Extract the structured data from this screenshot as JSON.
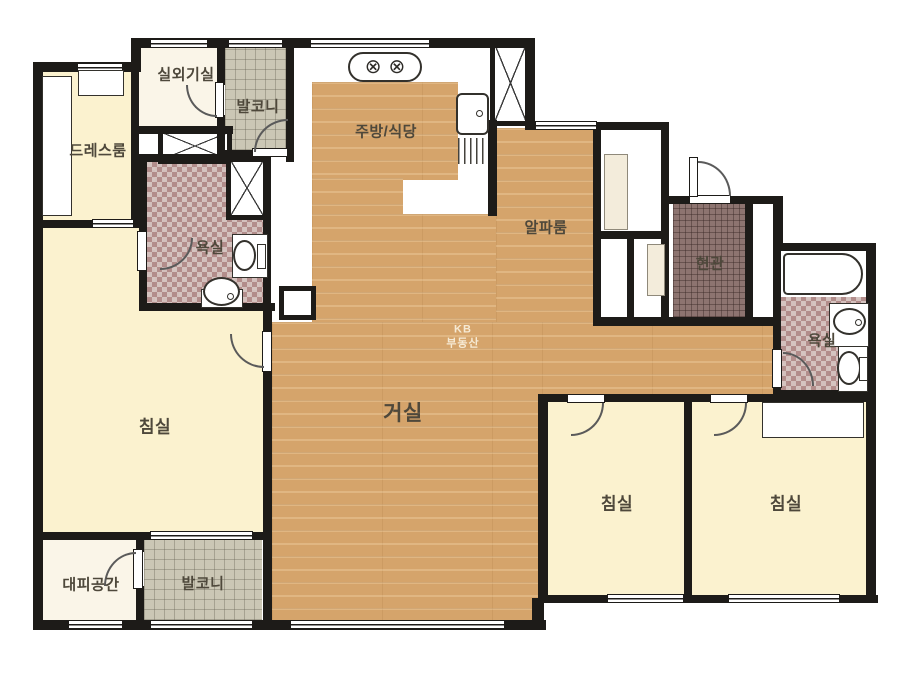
{
  "watermark": {
    "line1": "KB",
    "line2": "부동산"
  },
  "rooms": {
    "outdoor_unit": {
      "label": "실외기실"
    },
    "balcony_top": {
      "label": "발코니"
    },
    "dress_room": {
      "label": "드레스룸"
    },
    "bath_left": {
      "label": "욕실"
    },
    "kitchen_dining": {
      "label": "주방/식당"
    },
    "alpha_room": {
      "label": "알파룸"
    },
    "entrance": {
      "label": "현관"
    },
    "bath_right": {
      "label": "욕실"
    },
    "bedroom_left": {
      "label": "침실"
    },
    "living_room": {
      "label": "거실"
    },
    "evacuation_space": {
      "label": "대피공간"
    },
    "balcony_bottom": {
      "label": "발코니"
    },
    "bedroom_center": {
      "label": "침실"
    },
    "bedroom_right": {
      "label": "침실"
    }
  },
  "colors": {
    "wall": "#1d1b18",
    "wood_floor": "#d5a46b",
    "cream_room": "#fbf2cf",
    "off_white_room": "#faf5e8",
    "grey_balcony_tile": "#cbc7b5",
    "mosaic_bath_tile": "#c0a0a0",
    "entrance_tile": "#8d7470",
    "label_text": "#4e483b"
  }
}
